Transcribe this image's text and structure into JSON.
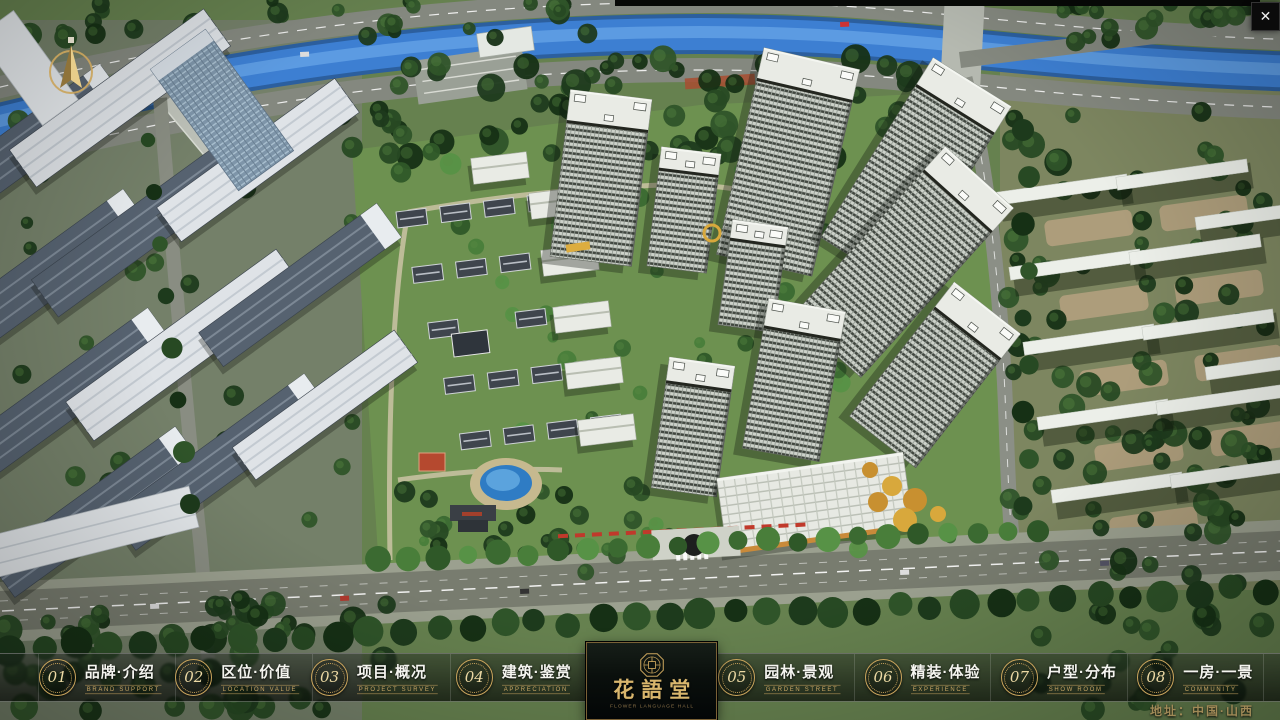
{
  "window": {
    "close_icon": "✕"
  },
  "nav": {
    "items": [
      {
        "num": "01",
        "title": "品牌·介绍",
        "sub": "BRAND SUPPORT"
      },
      {
        "num": "02",
        "title": "区位·价值",
        "sub": "LOCATION VALUE"
      },
      {
        "num": "03",
        "title": "项目·概况",
        "sub": "PROJECT SURVEY"
      },
      {
        "num": "04",
        "title": "建筑·鉴赏",
        "sub": "APPRECIATION"
      },
      {
        "num": "05",
        "title": "园林·景观",
        "sub": "GARDEN STREET"
      },
      {
        "num": "06",
        "title": "精装·体验",
        "sub": "EXPERIENCE"
      },
      {
        "num": "07",
        "title": "户型·分布",
        "sub": "SHOW ROOM"
      },
      {
        "num": "08",
        "title": "一房·一景",
        "sub": "COMMUNITY"
      }
    ],
    "logo": {
      "name": "花語堂",
      "tagline": "FLOWER LANGUAGE HALL"
    }
  },
  "footer": {
    "address": "地址：中国·山西"
  },
  "colors": {
    "accent_gold": "#c9a45c",
    "logo_gold": "#d9b66d",
    "water_blue": "#3d7fd2"
  }
}
